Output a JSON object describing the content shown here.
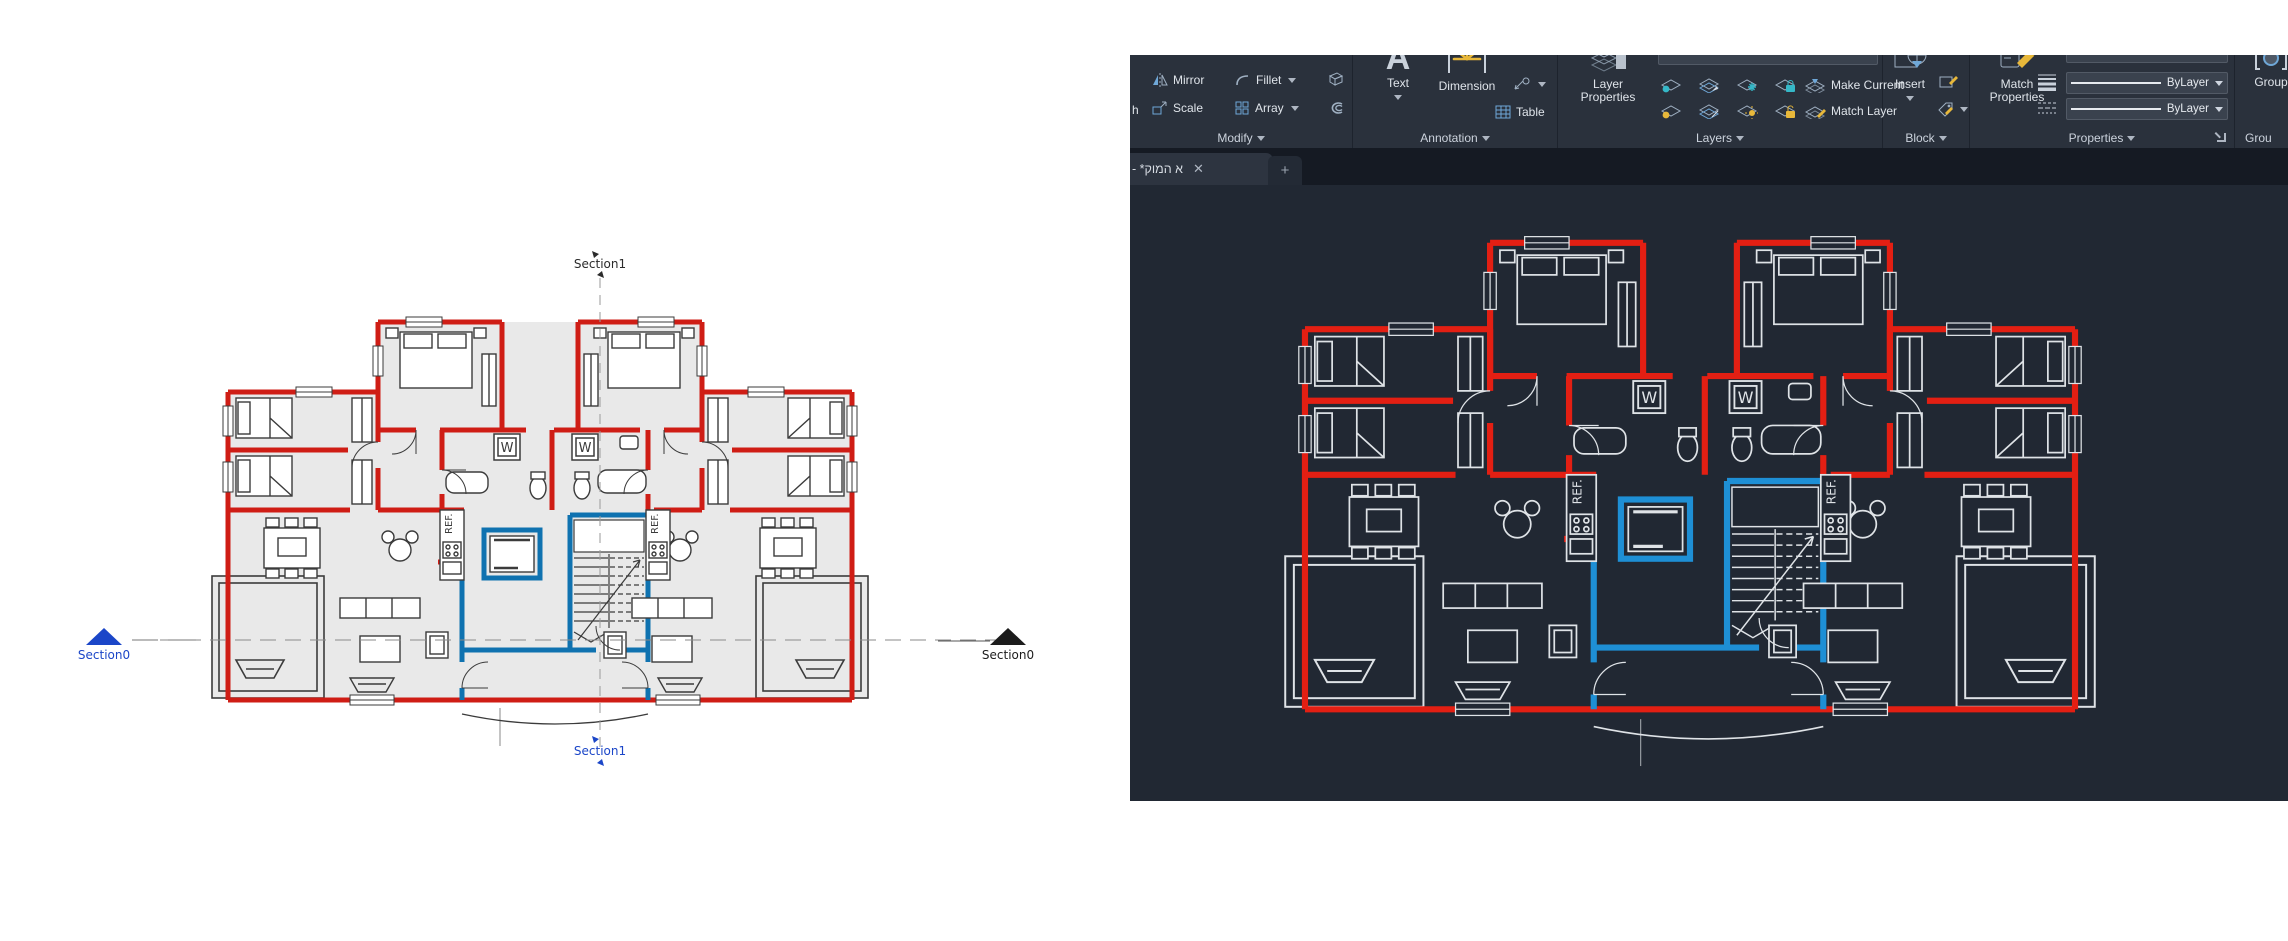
{
  "reference_plan": {
    "washer_label": "W",
    "fridge_label": "REF.",
    "section_top": "Section1",
    "section_bottom": "Section1",
    "section_left": "Section0",
    "section_right": "Section0"
  },
  "autocad": {
    "tab": {
      "title": "- *קומה א",
      "close": "✕",
      "new_tab": "+"
    },
    "ribbon": {
      "modify": {
        "clipped": "h",
        "mirror": "Mirror",
        "fillet": "Fillet",
        "scale": "Scale",
        "array": "Array",
        "panel": "Modify"
      },
      "annotation": {
        "text_icon": "A",
        "text": "Text",
        "dimension": "Dimension",
        "table": "Table",
        "panel": "Annotation"
      },
      "layers": {
        "layer_props_1": "Layer",
        "layer_props_2": "Properties",
        "make_current": "Make Current",
        "match_layer": "Match Layer",
        "panel": "Layers"
      },
      "block": {
        "insert": "Insert",
        "panel": "Block"
      },
      "properties": {
        "match_1": "Match",
        "match_2": "Properties",
        "lineweight_value": "ByLayer",
        "linetype_value": "ByLayer",
        "panel": "Properties"
      },
      "groups": {
        "group": "Group",
        "panel": "Grou"
      }
    }
  },
  "colors": {
    "canvas_bg": "#212833",
    "ribbon_bg": "#2a313c",
    "tabstrip_bg": "#151a23",
    "wall_red_light": "#cf1d15",
    "wall_red_dark": "#e31f13",
    "core_blue_light": "#0f72b0",
    "core_blue_dark": "#1e8fd5",
    "section_blue": "#1b46c8"
  }
}
